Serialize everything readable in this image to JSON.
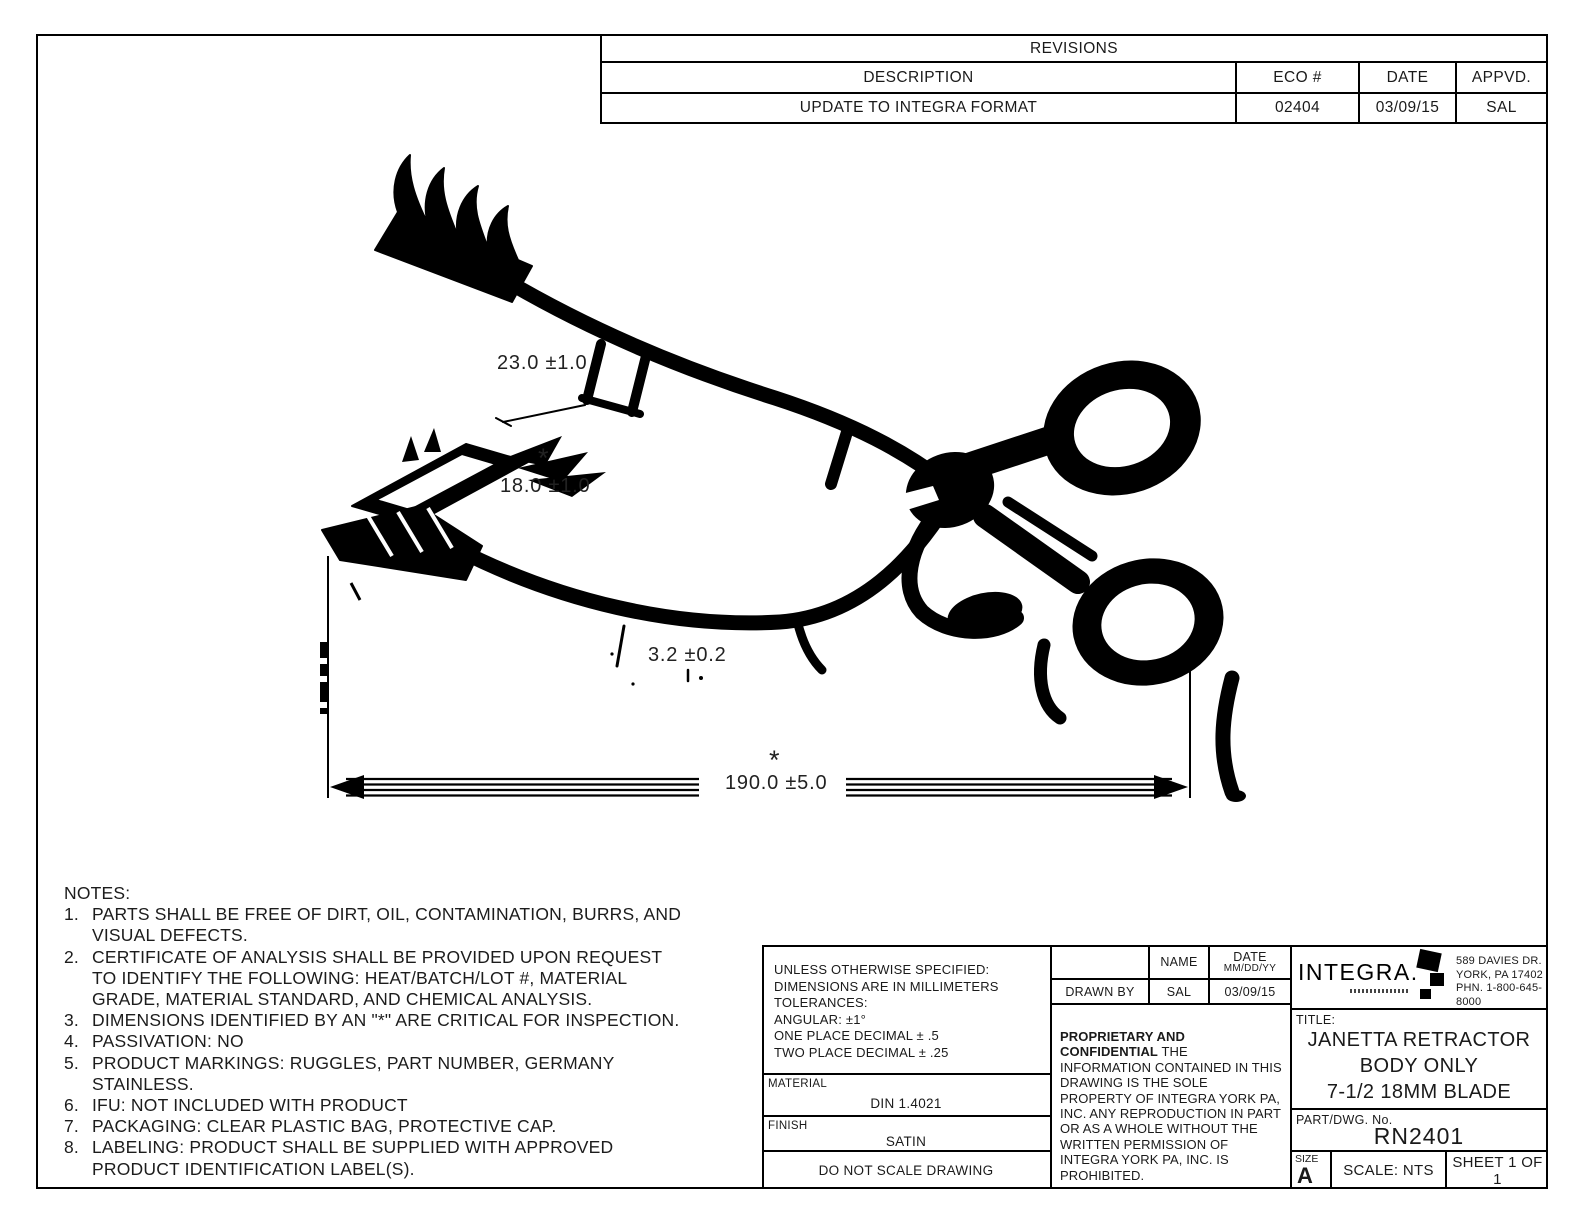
{
  "page": {
    "background": "#ffffff",
    "ink": "#000000"
  },
  "revisions": {
    "title": "REVISIONS",
    "headers": {
      "description": "DESCRIPTION",
      "eco": "ECO #",
      "date": "DATE",
      "appvd": "APPVD."
    },
    "rows": [
      {
        "description": "UPDATE TO INTEGRA FORMAT",
        "eco": "02404",
        "date": "03/09/15",
        "appvd": "SAL"
      }
    ]
  },
  "drawing_dimensions": {
    "dim_23": "23.0 ±1.0",
    "dim_18_star": "*",
    "dim_18": "18.0 ±1.0",
    "dim_3_2": "3.2 ±0.2",
    "dim_190_star": "*",
    "dim_190": "190.0 ±5.0"
  },
  "notes": {
    "heading": "NOTES:",
    "items": [
      {
        "num": "1.",
        "text": "PARTS SHALL BE FREE OF DIRT, OIL, CONTAMINATION, BURRS, AND VISUAL DEFECTS."
      },
      {
        "num": "2.",
        "text": "CERTIFICATE OF ANALYSIS SHALL BE PROVIDED UPON REQUEST TO IDENTIFY THE FOLLOWING: HEAT/BATCH/LOT #, MATERIAL GRADE, MATERIAL STANDARD, AND CHEMICAL ANALYSIS."
      },
      {
        "num": "3.",
        "text": "DIMENSIONS IDENTIFIED BY AN \"*\" ARE CRITICAL FOR INSPECTION."
      },
      {
        "num": "4.",
        "text": "PASSIVATION: NO"
      },
      {
        "num": "5.",
        "text": "PRODUCT MARKINGS: RUGGLES, PART NUMBER, GERMANY STAINLESS."
      },
      {
        "num": "6.",
        "text": "IFU: NOT INCLUDED WITH PRODUCT"
      },
      {
        "num": "7.",
        "text": "PACKAGING: CLEAR PLASTIC BAG, PROTECTIVE CAP."
      },
      {
        "num": "8.",
        "text": "LABELING: PRODUCT SHALL BE SUPPLIED WITH APPROVED PRODUCT IDENTIFICATION LABEL(S)."
      }
    ]
  },
  "title_block": {
    "tolerances": {
      "line1": "UNLESS OTHERWISE SPECIFIED:",
      "line2": "DIMENSIONS ARE IN MILLIMETERS",
      "line3": "TOLERANCES:",
      "line4": "ANGULAR: ±1°",
      "line5": "ONE PLACE DECIMAL ± .5",
      "line6": "TWO PLACE DECIMAL ± .25"
    },
    "material_label": "MATERIAL",
    "material_value": "DIN 1.4021",
    "finish_label": "FINISH",
    "finish_value": "SATIN",
    "do_not_scale": "DO NOT SCALE DRAWING",
    "sign_table": {
      "name_header": "NAME",
      "date_header": "DATE",
      "date_header_sub": "MM/DD/YY",
      "drawn_by_label": "DRAWN BY",
      "drawn_by_name": "SAL",
      "drawn_by_date": "03/09/15"
    },
    "proprietary": {
      "heading": "PROPRIETARY AND CONFIDENTIAL",
      "body": "THE INFORMATION CONTAINED IN THIS DRAWING IS THE SOLE PROPERTY OF INTEGRA YORK PA, INC.  ANY REPRODUCTION IN PART OR AS A WHOLE WITHOUT THE WRITTEN PERMISSION OF INTEGRA YORK PA, INC. IS PROHIBITED."
    },
    "company": {
      "brand": "INTEGRA.",
      "address1": "589 DAVIES DR.",
      "address2": "YORK, PA 17402",
      "address3": "PHN. 1-800-645-8000"
    },
    "title_label": "TITLE:",
    "title_line1": "JANETTA RETRACTOR",
    "title_line2": "BODY ONLY",
    "title_line3": "7-1/2 18MM BLADE",
    "part_label": "PART/DWG. No.",
    "part_number": "RN2401",
    "size_label": "SIZE",
    "size_value": "A",
    "scale": "SCALE: NTS",
    "sheet": "SHEET 1 OF 1"
  }
}
